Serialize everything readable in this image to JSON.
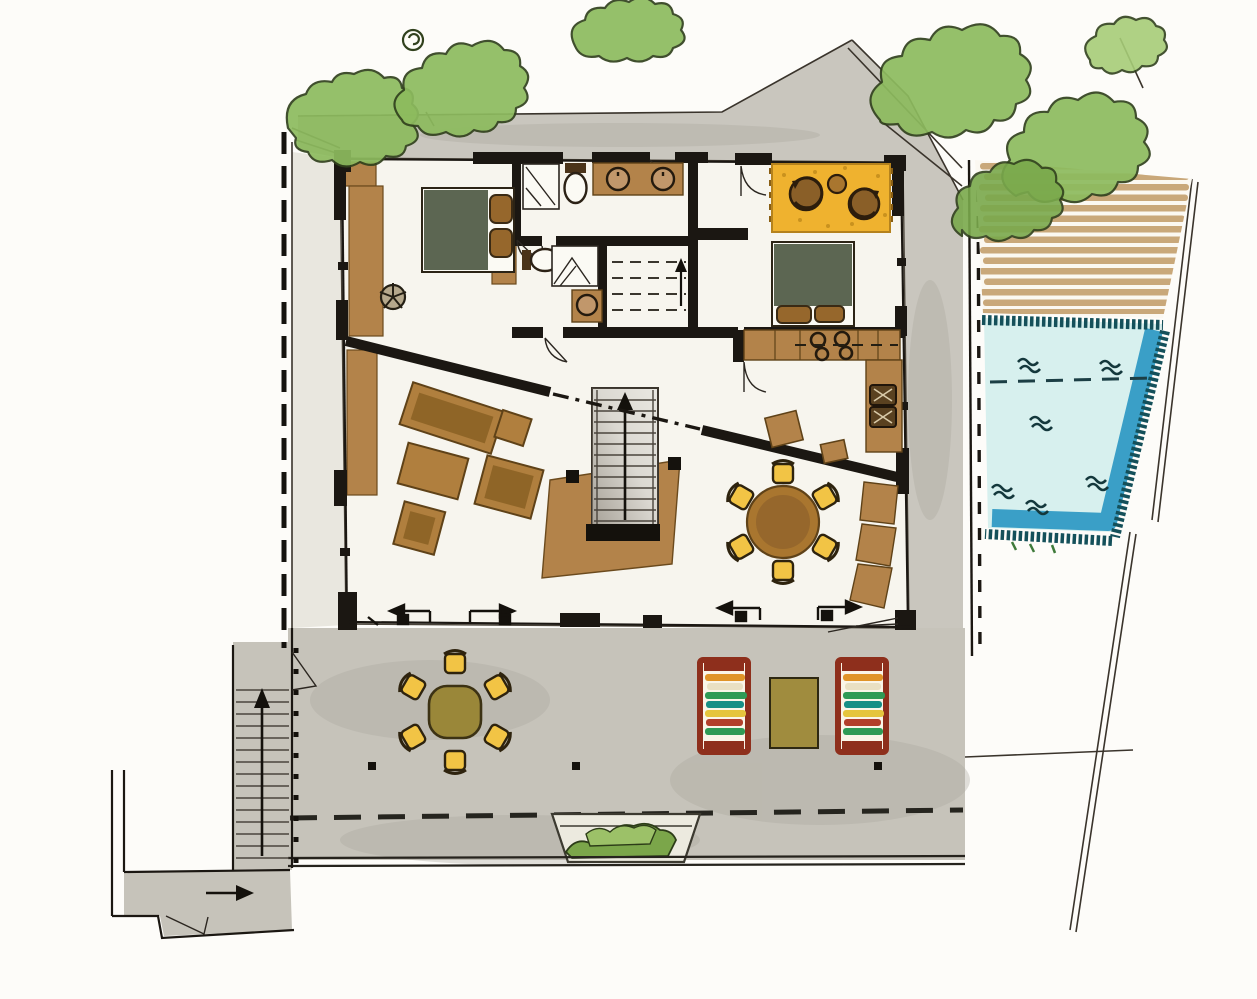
{
  "canvas": {
    "width": 1257,
    "height": 999
  },
  "drawing": {
    "kind": "hand-rendered architectural floor plan, ground floor with pool terrace",
    "visible_text": "none"
  },
  "palette": {
    "paper": "#f7f5ee",
    "path_gray": "#c9c6be",
    "terrace_gray": "#c6c3ba",
    "left_strip": "#e9e7df",
    "wall_black": "#1b1712",
    "wood": "#b3834a",
    "wood_dark": "#9c6f3a",
    "deck_plank": "#c9a87a",
    "furniture_brown": "#a9762f",
    "sofa_brown": "#b07f3e",
    "seat_inner": "#8f6527",
    "bed_blanket": "#5c6652",
    "pillow_brown": "#96672c",
    "chair_yellow": "#f2c445",
    "rug_orange": "#efb22f",
    "outdoor_table_olive": "#9a8739",
    "mat_olive": "#a08c3e",
    "pool_water": "#d7f0ee",
    "pool_deep": "#3a9fc7",
    "pool_tile": "#14505a",
    "tree_green": "#8dbb5e",
    "tree_green_light": "#a7cd78",
    "tree_outline": "#31411d",
    "lounger_red": "#8e2f1c",
    "stripe_orange": "#e09428",
    "stripe_cream": "#e9e0c3",
    "stripe_green": "#2f9a55",
    "stripe_teal": "#178f85",
    "stripe_yellow": "#e5c53d",
    "stripe_red": "#b23f2a",
    "planter_green": "#7ba64a",
    "planter_green_light": "#9cc168",
    "stair_gray": "#e9e7e1",
    "stair_shadow": "#8d867b"
  },
  "inventory": {
    "beds": 2,
    "bathrooms": 2,
    "toilets": 2,
    "showers": 2,
    "basin_sinks": 3,
    "stove_burners": 4,
    "interior_dining_chairs": 6,
    "outdoor_dining_chairs": 6,
    "swivel_chairs_on_rug": 2,
    "sun_loungers": 2,
    "stair_flights": 2,
    "pool_wave_marks": 6
  }
}
